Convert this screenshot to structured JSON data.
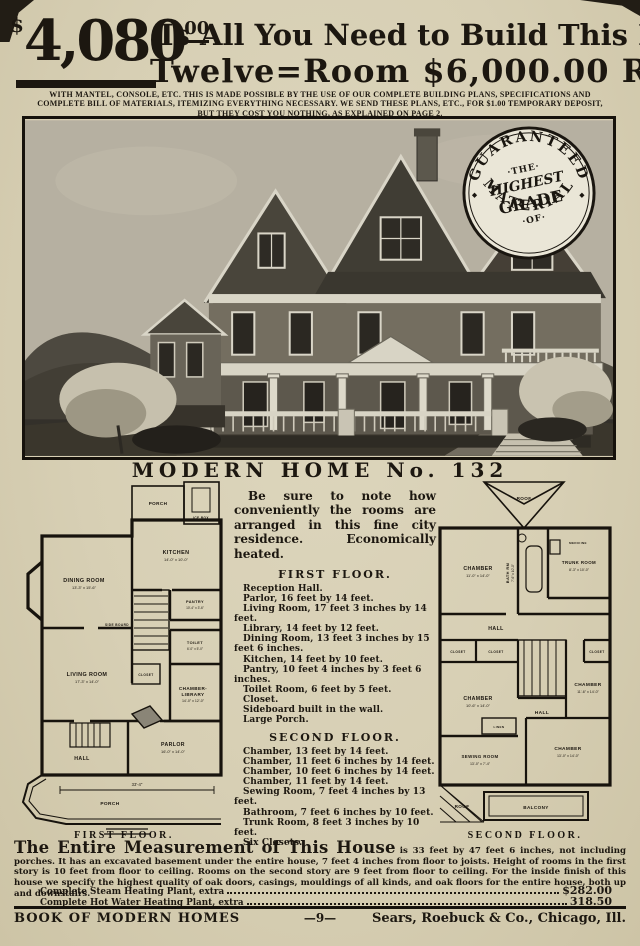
{
  "header": {
    "currency": "$",
    "price": "4,080",
    "cents": "00",
    "line1": "Is All You Need to Build This Elegant",
    "line2": "Twelve=Room   $6,000.00   Residence",
    "subhead": "WITH MANTEL, CONSOLE, ETC.  THIS IS MADE POSSIBLE BY THE USE OF OUR COMPLETE BUILDING PLANS, SPECIFICATIONS AND COMPLETE BILL OF MATERIALS, ITEMIZING EVERYTHING NECESSARY.  WE SEND THESE PLANS, ETC., FOR $1.00 TEMPORARY DEPOSIT, BUT THEY COST YOU NOTHING, AS EXPLAINED ON PAGE 2."
  },
  "seal": {
    "top": "GUARANTEED",
    "bottom": "MATERIAL",
    "c1": "·THE·",
    "c2": "HIGHEST",
    "c3": "GRADE",
    "c4": "·OF·",
    "dot": "◆"
  },
  "title": "MODERN HOME No. 132",
  "intro": "Be sure to note how conveniently the rooms are arranged in this fine city residence.  Economically heated.",
  "first_floor": {
    "title": "FIRST FLOOR.",
    "items": [
      "Reception Hall.",
      "Parlor, 16 feet by 14 feet.",
      "Living Room, 17 feet 3 inches by 14 feet.",
      "Library, 14 feet by 12 feet.",
      "Dining Room, 13 feet 3 inches by 15 feet 6 inches.",
      "Kitchen, 14 feet by 10 feet.",
      "Pantry, 10 feet 4 inches by 3 feet 6 inches.",
      "Toilet Room, 6 feet by 5 feet.",
      "Closet.",
      "Sideboard built in the wall.",
      "Large Porch."
    ]
  },
  "second_floor": {
    "title": "SECOND FLOOR.",
    "items": [
      "Chamber, 13 feet by 14 feet.",
      "Chamber, 11 feet 6 inches by 14 feet.",
      "Chamber, 10 feet 6 inches by 14 feet.",
      "Chamber, 11 feet by 14 feet.",
      "Sewing Room, 7 feet 4 inches by 13 feet.",
      "Bathroom, 7 feet 6 inches by 10 feet.",
      "Trunk Room, 8 feet 3 inches by 10 feet.",
      "Six Closets."
    ]
  },
  "plans": {
    "first": {
      "caption": "FIRST FLOOR.",
      "porch_rear": "PORCH",
      "ice_box": "ICE BOX",
      "kitchen": {
        "n": "KITCHEN",
        "d": "14'-0\" x 10'-0\""
      },
      "dining": {
        "n": "DINING ROOM",
        "d": "13'-3\" x 15'-6\""
      },
      "pantry": {
        "n": "PANTRY",
        "d": "10'-4\" x 3'-6\""
      },
      "toilet": {
        "n": "TOILET",
        "d": "6'-0\" x 5'-0\""
      },
      "living": {
        "n": "LIVING ROOM",
        "d": "17'-3\" x 14'-0\""
      },
      "library1": "CHAMBER-",
      "library2": "LIBRARY",
      "library_d": "14'-0\" x 12'-0\"",
      "sideboard": "SIDE BOARD",
      "closet": "CLOSET",
      "hall": "HALL",
      "parlor": {
        "n": "PARLOR",
        "d": "16'-0\" x 14'-0\""
      },
      "porch_front": "PORCH",
      "width_dim": "33'-4\""
    },
    "second": {
      "caption": "SECOND FLOOR.",
      "roof_top": "ROOF",
      "chamber_nw": {
        "n": "CHAMBER",
        "d": "11'-0\" x 14'-0\""
      },
      "bath": {
        "n": "BATH RM",
        "d": "7'-6\" x 10'-0\""
      },
      "medicine": "MEDICINE",
      "trunk": {
        "n": "TRUNK ROOM",
        "d": "8'-3\" x 10'-0\""
      },
      "hall_upper": "HALL",
      "closet1": "CLOSET",
      "closet2": "CLOSET",
      "closet3": "CLOSET",
      "chamber_w": {
        "n": "CHAMBER",
        "d": "10'-6\" x 14'-0\""
      },
      "chamber_e": {
        "n": "CHAMBER",
        "d": "11'-6\" x 14'-0\""
      },
      "hall_lower": "HALL",
      "linen": "LINEN",
      "sewing": {
        "n": "SEWING ROOM",
        "d": "13'-0\" x 7'-4\""
      },
      "chamber_se": {
        "n": "CHAMBER",
        "d": "13'-0\" x 14'-0\""
      },
      "roof_low": "ROOF",
      "balcony": "BALCONY"
    }
  },
  "measurement": {
    "lead": "The Entire Measurement of This House",
    "body": "is 33 feet by 47 feet 6 inches, not including porches.  It has an excavated basement under the entire house, 7 feet 4 inches from floor to joists.  Height of rooms in the first story is 10 feet from floor to ceiling.  Rooms on the second story are 9 feet from floor to ceiling.  For the inside finish of this house we specify the highest quality of oak doors, casings, mouldings of all kinds, and oak floors for the entire house, both up and downstairs."
  },
  "extras": [
    {
      "label": "Complete Steam Heating Plant, extra",
      "price": "$282.00"
    },
    {
      "label": "Complete Hot Water Heating Plant, extra",
      "price": "318.50"
    }
  ],
  "footer": {
    "left": "BOOK OF MODERN HOMES",
    "center": "—9—",
    "right": "Sears, Roebuck & Co., Chicago, Ill."
  }
}
